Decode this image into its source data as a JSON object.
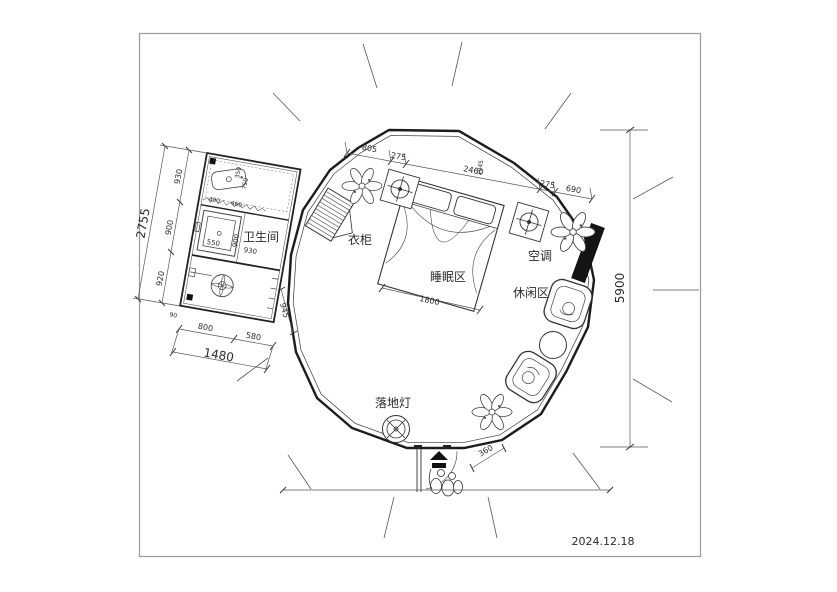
{
  "meta": {
    "date": "2024.12.18"
  },
  "labels": {
    "bathroom": "卫生间",
    "wardrobe": "衣柜",
    "sleeping_area": "睡眠区",
    "leisure_area": "休闲区",
    "air_conditioner": "空调",
    "floor_lamp": "落地灯"
  },
  "dimensions": {
    "top_chain": {
      "seg1": "805",
      "seg2": "275",
      "seg3": "2460",
      "seg3_side": "1045",
      "seg4": "275",
      "seg5": "690"
    },
    "right_overall": "5900",
    "bed_width": "1800",
    "entrance_width": "360",
    "bathroom": {
      "left_total": "2755",
      "left_seg1": "930",
      "left_seg2": "900",
      "left_seg3": "920",
      "bottom_seg1": "800",
      "bottom_seg2": "580",
      "bottom_total": "1480",
      "right_side": "945",
      "shower": "550",
      "inner_900": "900",
      "inner_930": "930",
      "small_350": "350",
      "small_750": "750",
      "small_400": "400",
      "small_460": "460",
      "small_90": "90"
    }
  }
}
